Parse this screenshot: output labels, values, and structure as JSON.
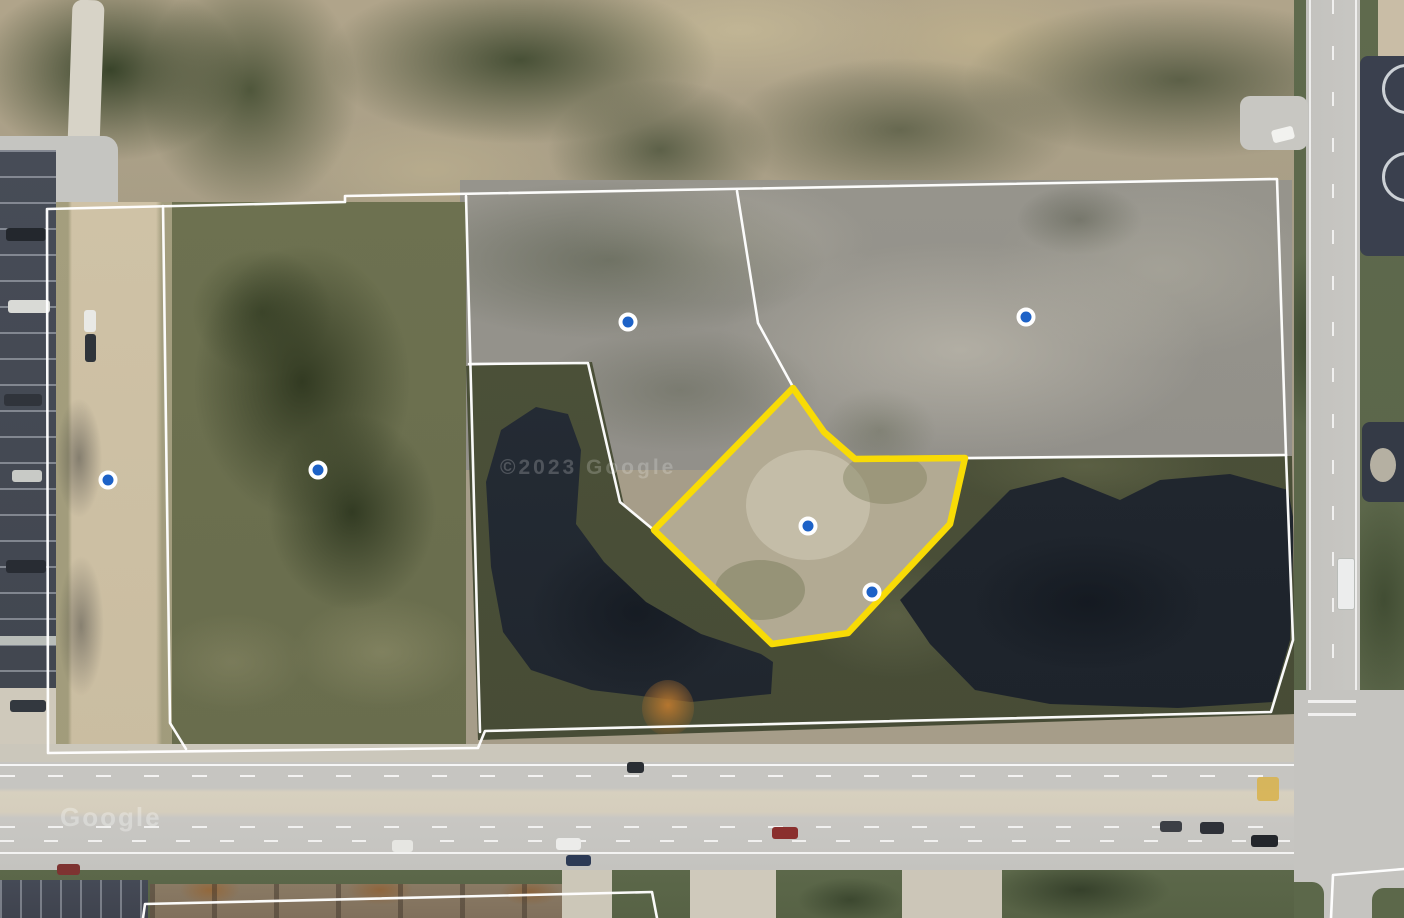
{
  "map": {
    "type": "aerial-satellite-parcel-view",
    "attribution_center": "©2023 Google",
    "attribution_road": "Google",
    "overlay": {
      "highlight_color": "#F8DB06",
      "boundary_color": "#FFFFFF",
      "marker_fill": "#1D62C7",
      "marker_ring": "#FFFFFF"
    },
    "markers": [
      {
        "id": "marker-driveway-west",
        "x": 108,
        "y": 480
      },
      {
        "id": "marker-west-parcel",
        "x": 318,
        "y": 470
      },
      {
        "id": "marker-north-central-parcel",
        "x": 628,
        "y": 322
      },
      {
        "id": "marker-northeast-parcel",
        "x": 1026,
        "y": 317
      },
      {
        "id": "marker-highlight-center",
        "x": 808,
        "y": 526
      },
      {
        "id": "marker-highlight-south",
        "x": 872,
        "y": 592
      }
    ],
    "highlight_parcel": {
      "id": "selected-parcel",
      "points": "793,388 824,432 855,459 965,458 950,524 848,633 772,644 654,530"
    },
    "boundary_lines": [
      {
        "id": "outer-boundary",
        "points": "47,209 345,202 345,196 1277,179 1286,455 1293,640 1271,712 485,731 478,748 48,753 47,209"
      },
      {
        "id": "west-strip-divider",
        "points": "163,206 170,723 186,749"
      },
      {
        "id": "west-parcel-divider",
        "points": "466,196 480,732"
      },
      {
        "id": "lake-west-divider",
        "points": "469,364 588,363 620,502 655,531"
      },
      {
        "id": "northeast-divider",
        "points": "737,191 758,323 793,387"
      },
      {
        "id": "lake-east-divider",
        "points": "966,458 1286,455"
      },
      {
        "id": "south-parcel-outline",
        "points": "143,918 145,904 652,892 657,918"
      },
      {
        "id": "southeast-parcel-outline",
        "points": "1331,918 1333,875 1404,869"
      }
    ]
  }
}
